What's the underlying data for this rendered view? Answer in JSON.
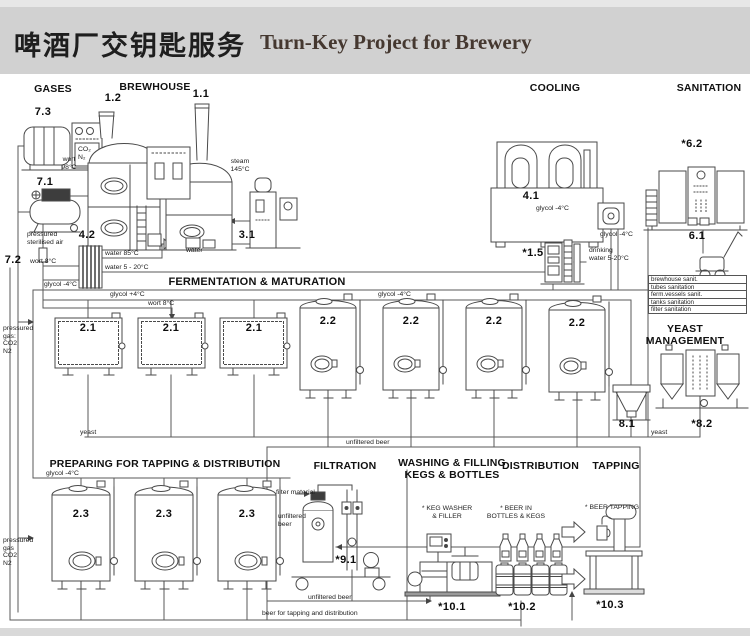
{
  "title": {
    "zh": "啤酒厂交钥匙服务",
    "en": "Turn-Key Project for Brewery"
  },
  "sections": {
    "gases": "GASES",
    "brewhouse": "BREWHOUSE",
    "cooling": "COOLING",
    "sanitation": "SANITATION",
    "fermentation": "FERMENTATION & MATURATION",
    "yeast_management": "YEAST\nMANAGEMENT",
    "preparing": "PREPARING FOR TAPPING & DISTRIBUTION",
    "filtration": "FILTRATION",
    "washing": "WASHING & FILLING\nKEGS & BOTTLES",
    "distribution": "DISTRIBUTION",
    "tapping": "TAPPING"
  },
  "equipment": [
    {
      "t": "7.3",
      "x": 28,
      "y": 106,
      "w": 30
    },
    {
      "t": "1.2",
      "x": 98,
      "y": 92,
      "w": 30
    },
    {
      "t": "1.1",
      "x": 186,
      "y": 88,
      "w": 30
    },
    {
      "t": "7.1",
      "x": 30,
      "y": 176,
      "w": 30
    },
    {
      "t": "7.2",
      "x": 0,
      "y": 254,
      "w": 26
    },
    {
      "t": "4.2",
      "x": 72,
      "y": 229,
      "w": 30
    },
    {
      "t": "3.1",
      "x": 232,
      "y": 229,
      "w": 30
    },
    {
      "t": "4.1",
      "x": 516,
      "y": 190,
      "w": 30
    },
    {
      "t": "*6.2",
      "x": 674,
      "y": 138,
      "w": 36
    },
    {
      "t": "6.1",
      "x": 682,
      "y": 230,
      "w": 30
    },
    {
      "t": "*1.5",
      "x": 516,
      "y": 247,
      "w": 34
    },
    {
      "t": "2.1",
      "x": 73,
      "y": 322,
      "w": 30
    },
    {
      "t": "2.1",
      "x": 156,
      "y": 322,
      "w": 30
    },
    {
      "t": "2.1",
      "x": 239,
      "y": 322,
      "w": 30
    },
    {
      "t": "2.2",
      "x": 313,
      "y": 315,
      "w": 30
    },
    {
      "t": "2.2",
      "x": 396,
      "y": 315,
      "w": 30
    },
    {
      "t": "2.2",
      "x": 479,
      "y": 315,
      "w": 30
    },
    {
      "t": "2.2",
      "x": 562,
      "y": 317,
      "w": 30
    },
    {
      "t": "8.1",
      "x": 612,
      "y": 418,
      "w": 30
    },
    {
      "t": "*8.2",
      "x": 684,
      "y": 418,
      "w": 36
    },
    {
      "t": "2.3",
      "x": 66,
      "y": 508,
      "w": 30
    },
    {
      "t": "2.3",
      "x": 149,
      "y": 508,
      "w": 30
    },
    {
      "t": "2.3",
      "x": 232,
      "y": 508,
      "w": 30
    },
    {
      "t": "*9.1",
      "x": 328,
      "y": 554,
      "w": 36
    },
    {
      "t": "*10.1",
      "x": 430,
      "y": 601,
      "w": 44
    },
    {
      "t": "*10.2",
      "x": 500,
      "y": 601,
      "w": 44
    },
    {
      "t": "*10.3",
      "x": 588,
      "y": 599,
      "w": 44
    }
  ],
  "labels": [
    {
      "t": "wort\n98°C",
      "x": 52,
      "y": 156,
      "w": 34,
      "al": "c"
    },
    {
      "t": "steam\n145°C",
      "x": 222,
      "y": 158,
      "w": 36,
      "al": "c"
    },
    {
      "t": "pressured\nsterilised air",
      "x": 27,
      "y": 231,
      "w": 50
    },
    {
      "t": "wort 8°C",
      "x": 30,
      "y": 258,
      "w": 40
    },
    {
      "t": "water 85°C",
      "x": 105,
      "y": 250,
      "w": 50
    },
    {
      "t": "water 5 - 20°C",
      "x": 105,
      "y": 264,
      "w": 60
    },
    {
      "t": "water",
      "x": 186,
      "y": 247,
      "w": 30
    },
    {
      "t": "glycol -4°C",
      "x": 44,
      "y": 281,
      "w": 50
    },
    {
      "t": "glycol +4°C",
      "x": 110,
      "y": 291,
      "w": 50
    },
    {
      "t": "wort 8°C",
      "x": 148,
      "y": 300,
      "w": 40
    },
    {
      "t": "glycol -4°C",
      "x": 378,
      "y": 291,
      "w": 50
    },
    {
      "t": "glycol -4°C",
      "x": 536,
      "y": 205,
      "w": 50
    },
    {
      "t": "glycol -4°C",
      "x": 600,
      "y": 231,
      "w": 50
    },
    {
      "t": "drinking\nwater 5-20°C",
      "x": 589,
      "y": 247,
      "w": 55
    },
    {
      "t": "pressured\ngas:\nCO2\nN2",
      "x": 3,
      "y": 325,
      "w": 40
    },
    {
      "t": "pressured\ngas\nCO2\nN2",
      "x": 3,
      "y": 537,
      "w": 40
    },
    {
      "t": "CO₂\nN₂",
      "x": 78,
      "y": 146,
      "w": 20
    },
    {
      "t": "yeast",
      "x": 80,
      "y": 429,
      "w": 30
    },
    {
      "t": "yeast",
      "x": 651,
      "y": 429,
      "w": 30
    },
    {
      "t": "unfiltered beer",
      "x": 346,
      "y": 439,
      "w": 60
    },
    {
      "t": "glycol -4°C",
      "x": 46,
      "y": 470,
      "w": 50
    },
    {
      "t": "filter material",
      "x": 276,
      "y": 489,
      "w": 52
    },
    {
      "t": "unfiltered\nbeer",
      "x": 278,
      "y": 513,
      "w": 40
    },
    {
      "t": "unfiltered beer",
      "x": 308,
      "y": 594,
      "w": 60
    },
    {
      "t": "beer for tapping and distribution",
      "x": 262,
      "y": 610,
      "w": 140
    },
    {
      "t": "* KEG WASHER\n& FILLER",
      "x": 410,
      "y": 505,
      "w": 74,
      "al": "c"
    },
    {
      "t": "* BEER IN\nBOTTLES & KEGS",
      "x": 476,
      "y": 505,
      "w": 80,
      "al": "c"
    },
    {
      "t": "* BEER TAPPING",
      "x": 570,
      "y": 504,
      "w": 84,
      "al": "c"
    }
  ],
  "sanitation_list": [
    "brewhouse sanit.",
    "tubes sanitation",
    "ferm.vessels sanit.",
    "tanks sanitation",
    "filter sanitation"
  ],
  "colors": {
    "header_bg": "#d1d1d1",
    "line": "#444444",
    "title_en": "#453830"
  }
}
